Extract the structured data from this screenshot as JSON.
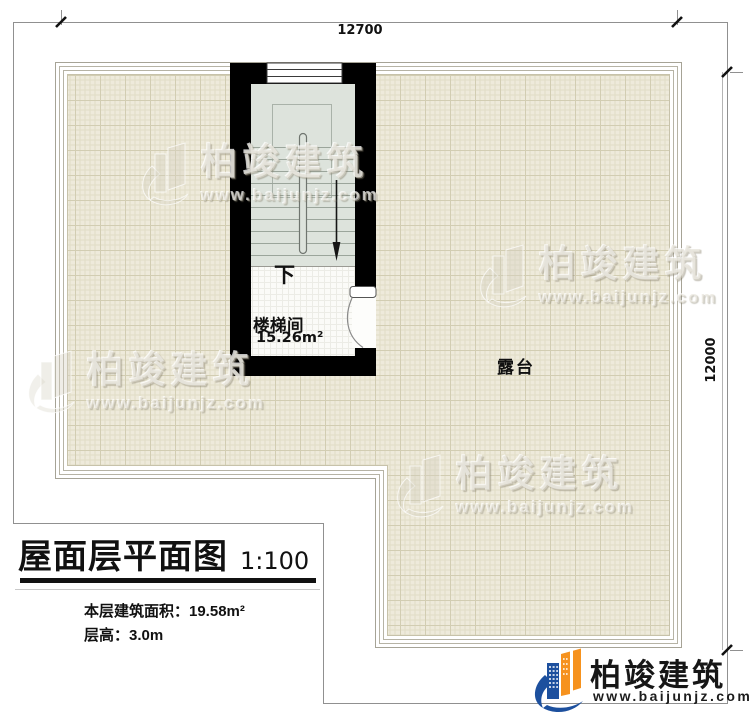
{
  "colors": {
    "wall": "#000000",
    "tile_fill": "#eeeadb",
    "stair_fill": "#dde3dc",
    "accent_orange": "#f6921e",
    "accent_blue": "#1d509e"
  },
  "plan": {
    "dimension_top": "12700",
    "dimension_right": "12000",
    "stairwell": {
      "label": "楼梯间",
      "area": "15.26m²",
      "direction_label": "下"
    },
    "terrace": {
      "label": "露台"
    }
  },
  "title_block": {
    "title": "屋面层平面图",
    "scale": "1:100",
    "area_line": "本层建筑面积：19.58m²",
    "height_line": "层高：3.0m"
  },
  "branding": {
    "logo": {
      "name": "柏竣建筑",
      "url": "www.baijunjz.com"
    },
    "watermark": {
      "name": "柏竣建筑",
      "url": "www.baijunjz.com"
    }
  }
}
